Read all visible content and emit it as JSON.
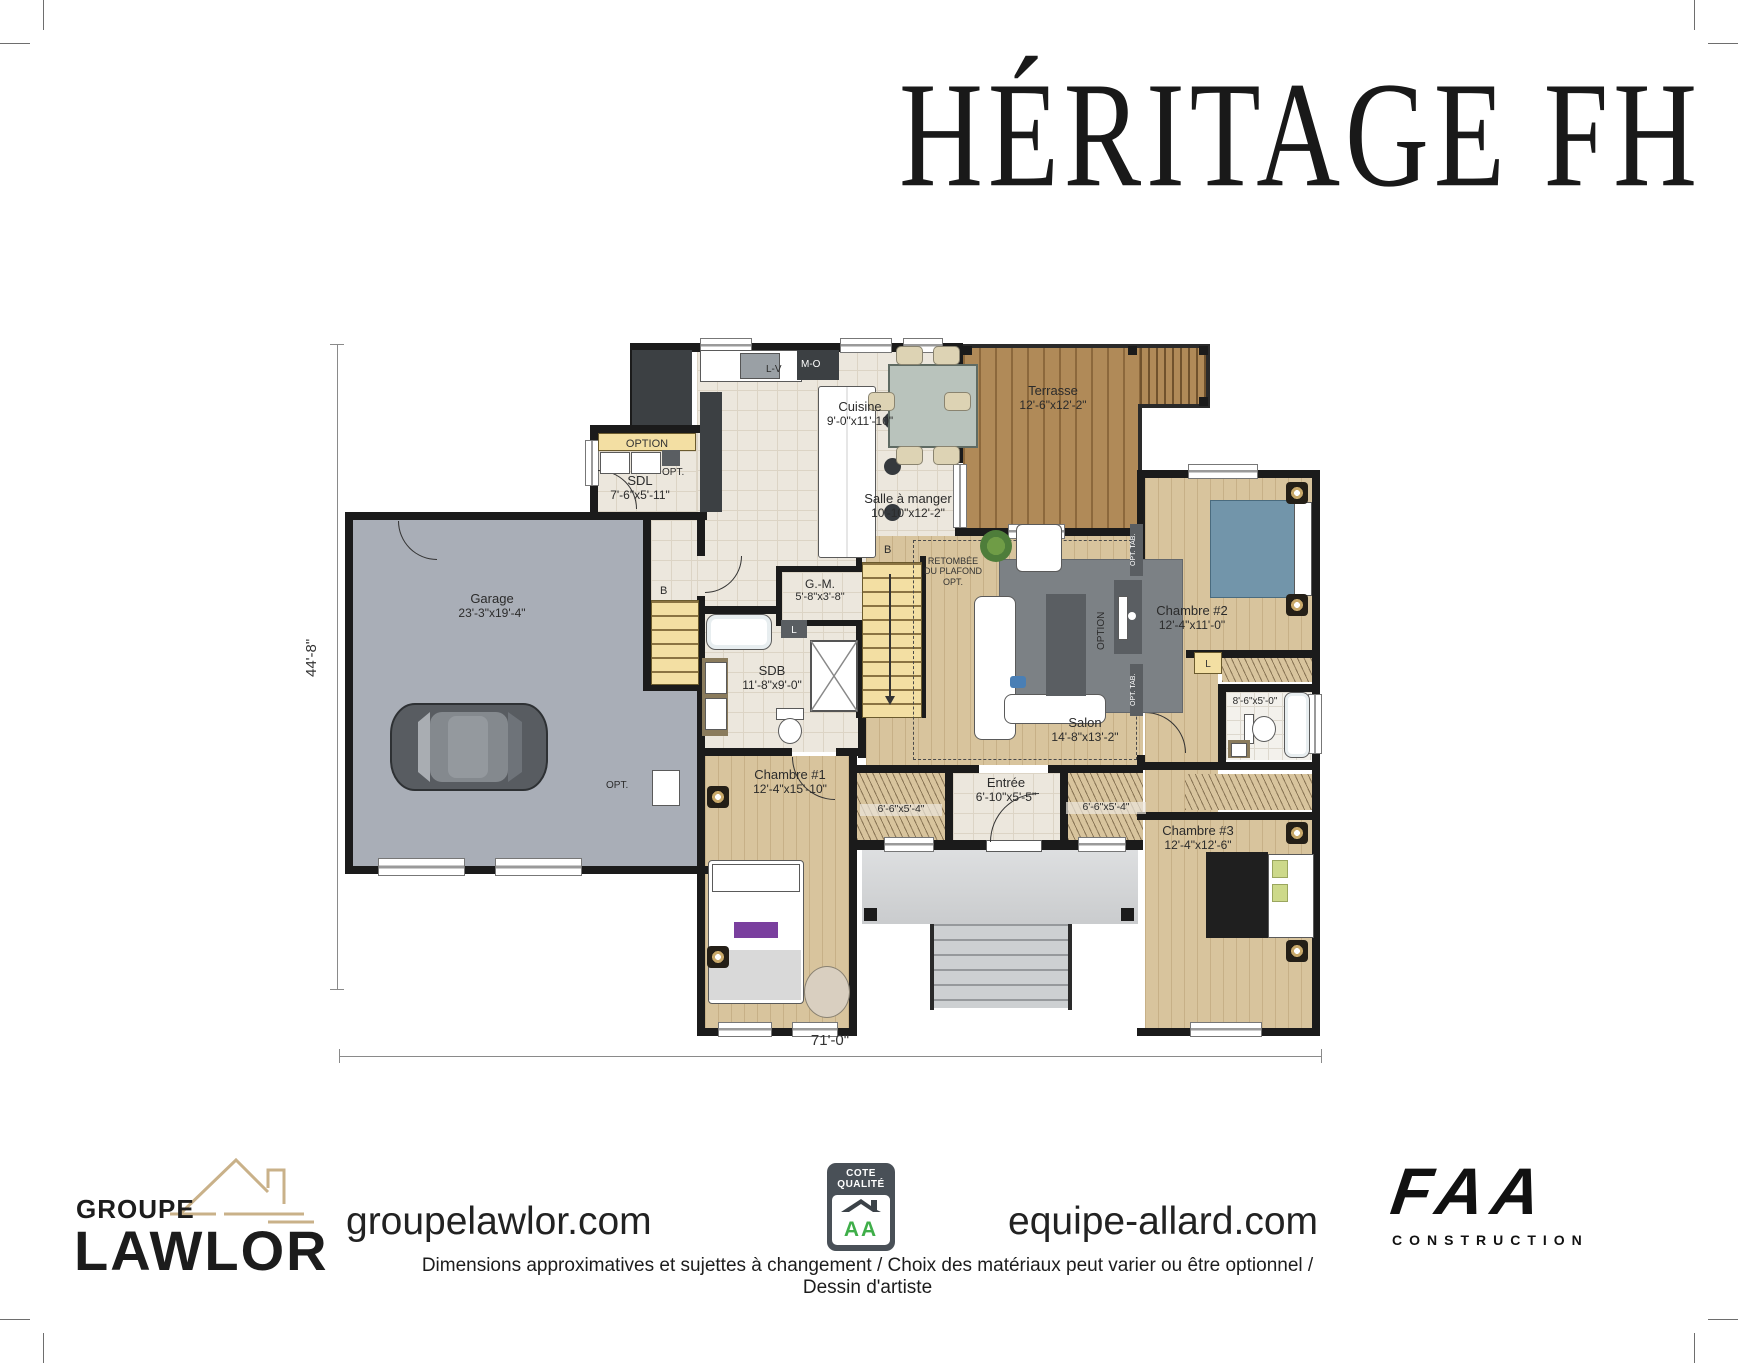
{
  "title": "HÉRITAGE FH",
  "plan": {
    "height_dim": "44'-8\"",
    "width_dim": "71'-0\"",
    "rooms": {
      "garage": {
        "name": "Garage",
        "dims": "23'-3\"x19'-4\""
      },
      "sdl": {
        "name": "SDL",
        "dims": "7'-6\"x5'-11\""
      },
      "cuisine": {
        "name": "Cuisine",
        "dims": "9'-0\"x11'-10\""
      },
      "salle_a_manger": {
        "name": "Salle à manger",
        "dims": "10'-10\"x12'-2\""
      },
      "terrasse": {
        "name": "Terrasse",
        "dims": "12'-6\"x12'-2\""
      },
      "gm": {
        "name": "G.-M.",
        "dims": "5'-8\"x3'-8\""
      },
      "sdb": {
        "name": "SDB",
        "dims": "11'-8\"x9'-0\""
      },
      "salon": {
        "name": "Salon",
        "dims": "14'-8\"x13'-2\""
      },
      "chambre1": {
        "name": "Chambre #1",
        "dims": "12'-4\"x15'-10\""
      },
      "chambre2": {
        "name": "Chambre #2",
        "dims": "12'-4\"x11'-0\""
      },
      "chambre3": {
        "name": "Chambre #3",
        "dims": "12'-4\"x12'-6\""
      },
      "entree": {
        "name": "Entrée",
        "dims": "6'-10\"x5'-5\""
      },
      "bain2": {
        "dims": "8'-6\"x5'-0\""
      },
      "closet_left": {
        "dims": "6'-6\"x5'-4\""
      },
      "closet_right": {
        "dims": "6'-6\"x5'-4\""
      }
    },
    "annotations": {
      "option": "OPTION",
      "opt": "OPT.",
      "opt_tab": "OPT. TAB.",
      "retombee_l1": "RETOMBÉE",
      "retombee_l2": "DU PLAFOND",
      "retombee_l3": "OPT.",
      "b": "B",
      "l": "L",
      "lv": "L-V",
      "mo": "M-O"
    }
  },
  "footer": {
    "lawlor_top": "GROUPE",
    "lawlor_main": "LAWLOR",
    "site_left": "groupelawlor.com",
    "badge_line1": "COTE",
    "badge_line2": "QUALITÉ",
    "badge_a1": "A",
    "badge_a2": "A",
    "site_right": "equipe-allard.com",
    "faa": "FAA",
    "faa_sub": "CONSTRUCTION",
    "disclaimer": "Dimensions approximatives et sujettes à changement / Choix des matériaux peut varier ou être optionnel / Dessin d'artiste"
  },
  "colors": {
    "wall": "#1b1b1b",
    "tile": "#ece7dd",
    "wood": "#d8c49d",
    "deck": "#b08a58",
    "garage": "#a9aeb7",
    "porch": "#d2d4d6",
    "accent_yellow": "#f3dfa3",
    "badge_green": "#3fae49",
    "badge_slate": "#495057",
    "lawlor_tan": "#c9b189"
  }
}
